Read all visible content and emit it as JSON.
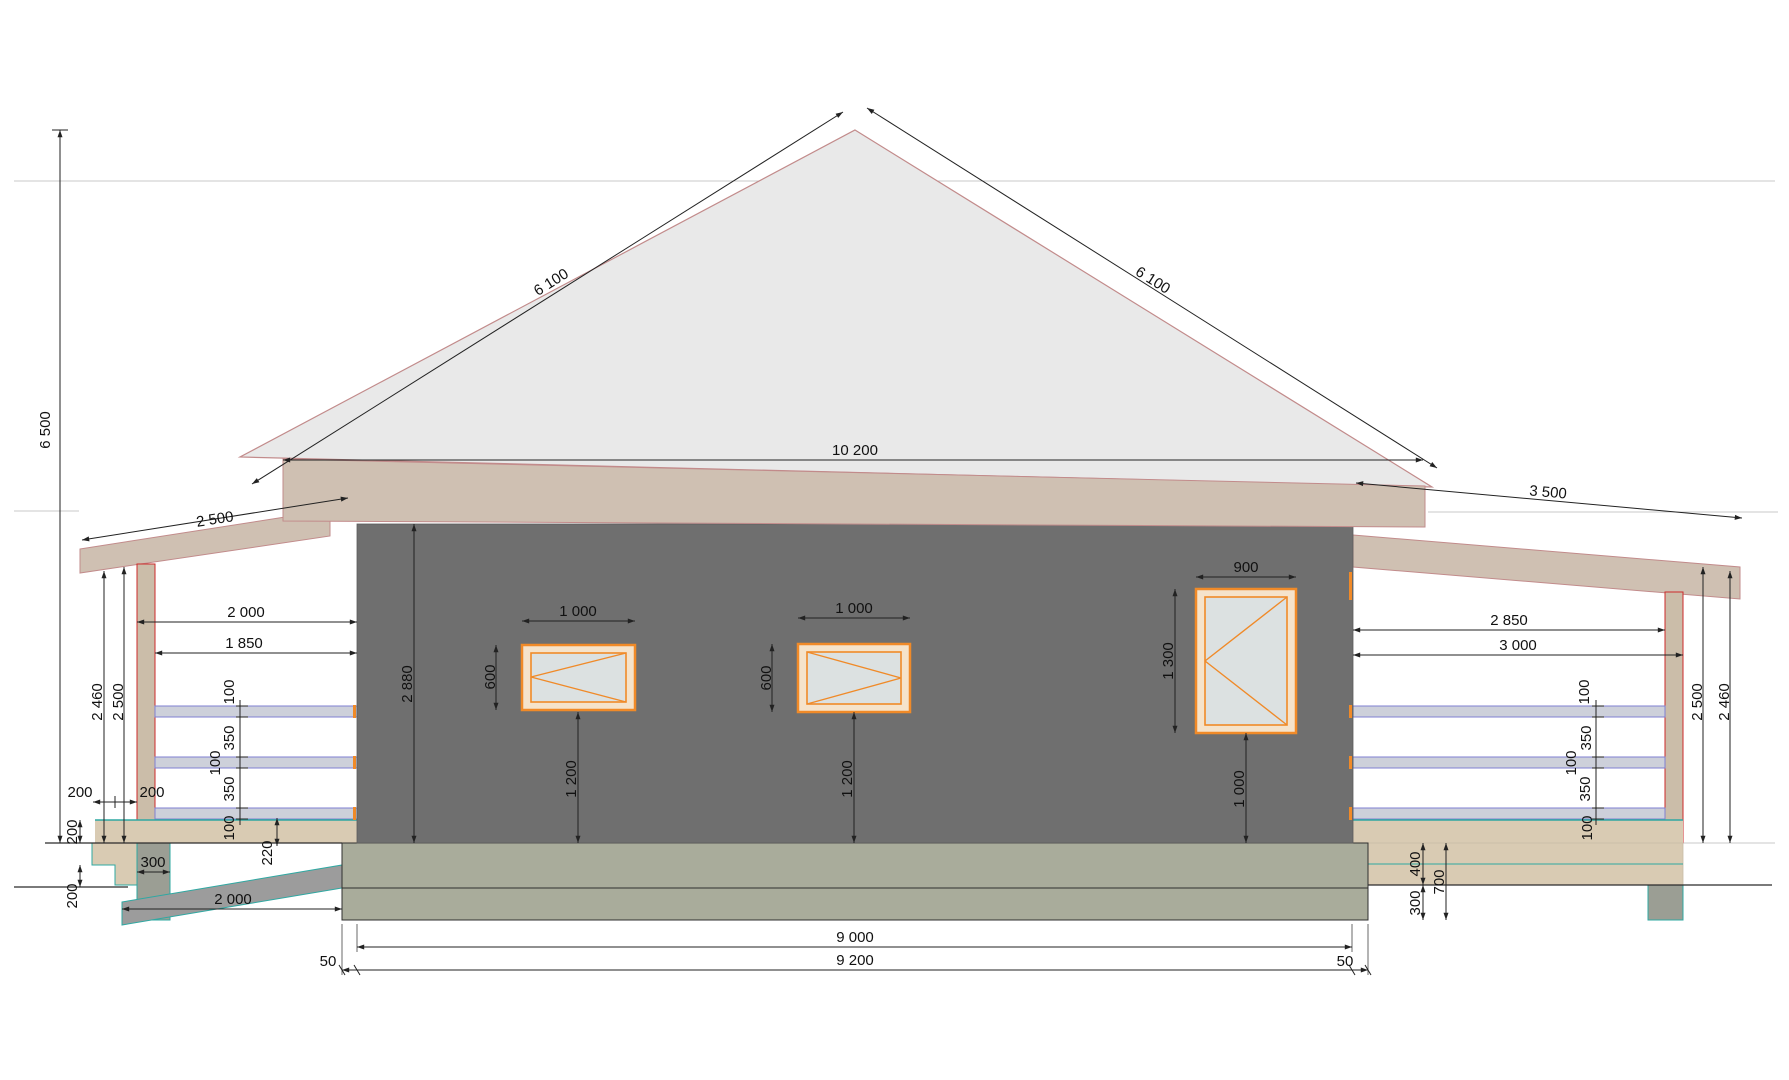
{
  "title": "House cross-section elevation drawing",
  "colors": {
    "roof_fill": "#e9e9e9",
    "roof_outline": "#c28b8b",
    "fascia_fill": "#cfc0b2",
    "wall_fill": "#6f6f6f",
    "foundation_fill": "#a9ac9b",
    "deck_fill": "#d9cbb3",
    "rail_fill": "#cdd0da",
    "rail_line": "#7f7fd2",
    "teal_line": "#2fa8a2",
    "pier_fill": "#9b9e94",
    "window_orange": "#f08a28",
    "window_glass": "#dce1e1"
  },
  "dims": {
    "total_height": "6 500",
    "roof": {
      "left_slope": "6 100",
      "right_slope": "6 100",
      "span": "10 200"
    },
    "wall": {
      "height": "2 880"
    },
    "windows": {
      "w1": {
        "width": "1 000",
        "height": "600",
        "sill": "1 200"
      },
      "w2": {
        "width": "1 000",
        "height": "600",
        "sill": "1 200"
      },
      "w3": {
        "width": "900",
        "height": "1 300",
        "sill": "1 000"
      }
    },
    "left_porch": {
      "roof_depth": "2 500",
      "clear_width": "2 000",
      "rail_width": "1 850",
      "post_height": "2 500",
      "rail_height": "2 460",
      "chain": [
        "100",
        "350",
        "100",
        "350",
        "100"
      ],
      "offsets": [
        "200",
        "200"
      ],
      "deck_thickness": "200",
      "ground_step": "200",
      "pier_width": "300",
      "ramp_length": "2 000",
      "ramp_step": "220"
    },
    "right_porch": {
      "roof_depth": "3 500",
      "clear_width": "2 850",
      "post_span": "3 000",
      "post_height": "2 500",
      "rail_height": "2 460",
      "chain": [
        "100",
        "350",
        "100",
        "350",
        "100"
      ],
      "deck_height": "400",
      "below_ground": "300",
      "total_drop": "700"
    },
    "base": {
      "inner_width": "9 000",
      "outer_width": "9 200",
      "offset_left": "50",
      "offset_right": "50"
    }
  }
}
